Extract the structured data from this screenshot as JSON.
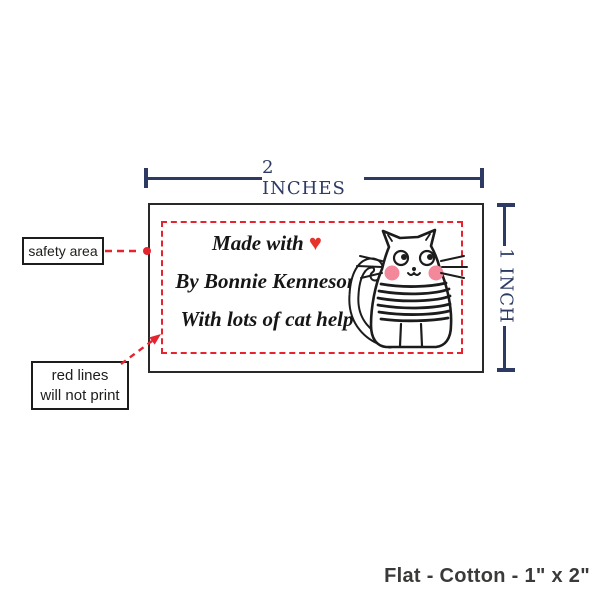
{
  "page": {
    "background": "#ffffff",
    "footer": "Flat - Cotton - 1\" x 2\""
  },
  "dimension_guides": {
    "width_text": "2 INCHES",
    "height_text": "1 INCH",
    "color": "#2c3a64"
  },
  "label": {
    "line1_prefix": "Made with",
    "heart": "♥",
    "line2": "By Bonnie Kenneson",
    "line3": "With lots of cat help",
    "text_color": "#161616",
    "heart_color": "#e8332a",
    "border_color": "#2b2829",
    "background": "#ffffff"
  },
  "safety_area": {
    "outline_color": "#e52430",
    "callout_text": "safety area"
  },
  "print_note": {
    "line1": "red lines",
    "line2": "will not print"
  },
  "cat_illustration": {
    "body_color": "#ffffff",
    "outline_color": "#1c1c1c",
    "cheek_color": "#f4889b"
  }
}
